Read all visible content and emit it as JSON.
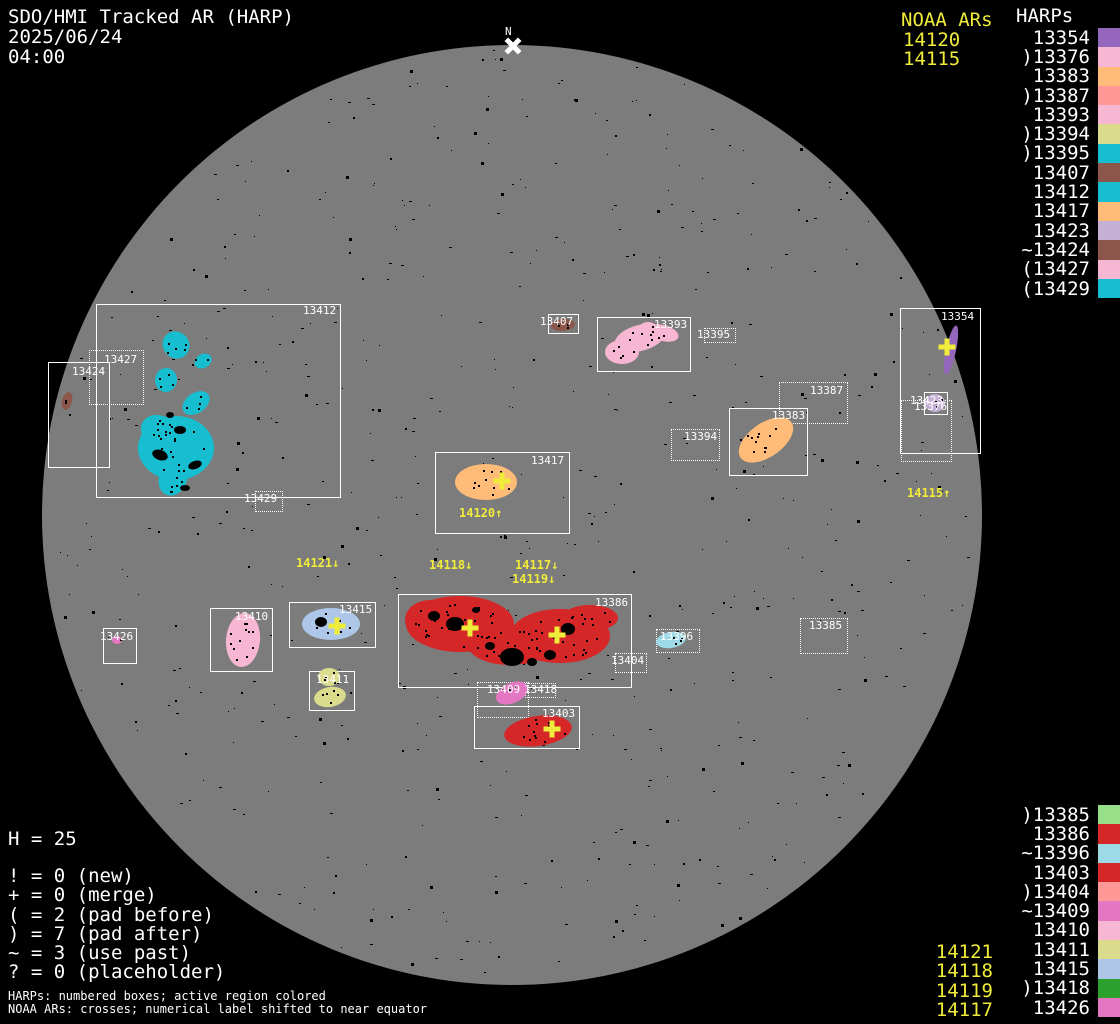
{
  "title": {
    "line1": "SDO/HMI Tracked AR (HARP)",
    "date": "2025/06/24",
    "time": "04:00"
  },
  "north": {
    "label": "N"
  },
  "colors": {
    "background": "#000000",
    "disk": "#7c7c7c",
    "box_line": "#ffffff",
    "noaa_yellow": "#f0ec3a"
  },
  "noaa_top": {
    "header": "NOAA ARs",
    "values": [
      "14120",
      "14115"
    ]
  },
  "harps": {
    "header": "HARPs",
    "top": [
      {
        "label": "13354",
        "color": "#9467bd"
      },
      {
        "label": ")13376",
        "color": "#f7b6d2"
      },
      {
        "label": "13383",
        "color": "#ffbb78"
      },
      {
        "label": ")13387",
        "color": "#ff9896"
      },
      {
        "label": "13393",
        "color": "#f7b6d2"
      },
      {
        "label": ")13394",
        "color": "#dbdb8d"
      },
      {
        "label": ")13395",
        "color": "#17becf"
      },
      {
        "label": "13407",
        "color": "#8c564b"
      },
      {
        "label": "13412",
        "color": "#17becf"
      },
      {
        "label": "13417",
        "color": "#ffbb78"
      },
      {
        "label": "13423",
        "color": "#c5b0d5"
      },
      {
        "label": "~13424",
        "color": "#8c564b"
      },
      {
        "label": "(13427",
        "color": "#f7b6d2"
      },
      {
        "label": "(13429",
        "color": "#17becf"
      }
    ],
    "bottom": [
      {
        "label": ")13385",
        "color": "#98df8a"
      },
      {
        "label": "13386",
        "color": "#d62728"
      },
      {
        "label": "~13396",
        "color": "#9edae5"
      },
      {
        "label": "13403",
        "color": "#d62728"
      },
      {
        "label": ")13404",
        "color": "#ff9896"
      },
      {
        "label": "~13409",
        "color": "#e377c2"
      },
      {
        "label": "13410",
        "color": "#f7b6d2"
      },
      {
        "label": "13411",
        "color": "#dbdb8d"
      },
      {
        "label": "13415",
        "color": "#aec7e8"
      },
      {
        "label": ")13418",
        "color": "#2ca02c"
      },
      {
        "label": "13426",
        "color": "#e377c2"
      }
    ]
  },
  "noaa_bottom": [
    "14121",
    "14118",
    "14119",
    "14117"
  ],
  "legend": {
    "h_line": "H = 25",
    "items": [
      "! = 0 (new)",
      "+ = 0 (merge)",
      "( = 2 (pad before)",
      ") = 7 (pad after)",
      "~ = 3 (use past)",
      "? = 0 (placeholder)"
    ],
    "footnote1": "HARPs: numbered boxes; active region colored",
    "footnote2": "NOAA ARs: crosses; numerical label shifted to near equator"
  },
  "disk": {
    "cx": 512,
    "cy": 515,
    "r": 470,
    "regions": [
      {
        "id": "13412",
        "box": [
          96,
          304,
          243,
          192
        ],
        "style": "solid",
        "label": [
          303,
          305
        ],
        "blobs": [
          [
            176,
            345,
            13,
            14,
            -40,
            "#17becf",
            5
          ],
          [
            203,
            361,
            9,
            7,
            -30,
            "#17becf",
            2
          ],
          [
            166,
            380,
            11,
            12,
            10,
            "#17becf",
            4
          ],
          [
            196,
            403,
            15,
            10,
            -35,
            "#17becf",
            4
          ],
          [
            176,
            448,
            38,
            32,
            0,
            "#17becf",
            18
          ],
          [
            173,
            478,
            14,
            18,
            20,
            "#17becf",
            6
          ],
          [
            160,
            432,
            20,
            16,
            30,
            "#17becf",
            6
          ],
          [
            180,
            430,
            6,
            4,
            0,
            "#000000",
            0
          ],
          [
            160,
            455,
            8,
            5,
            20,
            "#000000",
            0
          ],
          [
            195,
            465,
            7,
            4,
            -20,
            "#000000",
            0
          ],
          [
            170,
            415,
            4,
            3,
            0,
            "#000000",
            0
          ],
          [
            185,
            488,
            5,
            3,
            0,
            "#000000",
            0
          ]
        ]
      },
      {
        "id": "13427",
        "box": [
          89,
          350,
          53,
          53
        ],
        "style": "dotted",
        "label": [
          104,
          354
        ],
        "blobs": []
      },
      {
        "id": "13424",
        "box": [
          48,
          362,
          60,
          104
        ],
        "style": "solid",
        "label": [
          72,
          366
        ],
        "blobs": [
          [
            67,
            401,
            5,
            9,
            15,
            "#8c564b",
            2
          ]
        ]
      },
      {
        "id": "13429",
        "box": [
          255,
          491,
          26,
          19
        ],
        "style": "dotted",
        "label": [
          244,
          493
        ],
        "blobs": []
      },
      {
        "id": "13407",
        "box": [
          548,
          314,
          29,
          18
        ],
        "style": "solid",
        "label": [
          540,
          316
        ],
        "blobs": [
          [
            563,
            325,
            12,
            6,
            -5,
            "#8c564b",
            4
          ]
        ]
      },
      {
        "id": "13393",
        "box": [
          597,
          317,
          92,
          53
        ],
        "style": "solid",
        "label": [
          654,
          319
        ],
        "blobs": [
          [
            640,
            338,
            26,
            13,
            -15,
            "#f7b6d2",
            6
          ],
          [
            622,
            352,
            17,
            12,
            0,
            "#f7b6d2",
            5
          ],
          [
            663,
            333,
            16,
            8,
            15,
            "#f7b6d2",
            3
          ],
          [
            648,
            330,
            10,
            8,
            0,
            "#f7b6d2",
            2
          ]
        ]
      },
      {
        "id": "13395",
        "box": [
          704,
          328,
          30,
          13
        ],
        "style": "dotted",
        "label": [
          697,
          329
        ],
        "blobs": []
      },
      {
        "id": "13387",
        "box": [
          779,
          382,
          67,
          40
        ],
        "style": "dotted",
        "label": [
          810,
          385
        ],
        "blobs": []
      },
      {
        "id": "13383",
        "box": [
          729,
          408,
          77,
          66
        ],
        "style": "solid",
        "label": [
          772,
          410
        ],
        "blobs": [
          [
            766,
            440,
            31,
            17,
            -35,
            "#ffbb78",
            12
          ]
        ]
      },
      {
        "id": "13394",
        "box": [
          671,
          429,
          47,
          30
        ],
        "style": "dotted",
        "label": [
          684,
          431
        ],
        "blobs": []
      },
      {
        "id": "13354",
        "box": [
          900,
          308,
          79,
          144
        ],
        "style": "solid",
        "label": [
          941,
          311
        ],
        "blobs": [
          [
            951,
            350,
            5,
            25,
            12,
            "#9467bd",
            0
          ]
        ]
      },
      {
        "id": "13423",
        "box": [
          924,
          392,
          22,
          21
        ],
        "style": "solid",
        "label": [
          910,
          395
        ],
        "blobs": [
          [
            935,
            403,
            10,
            9,
            0,
            "#c5b0d5",
            3
          ]
        ]
      },
      {
        "id": "13376",
        "box": [
          901,
          400,
          49,
          60
        ],
        "style": "dotted",
        "label": [
          914,
          401
        ],
        "blobs": []
      },
      {
        "id": "13417",
        "box": [
          435,
          452,
          133,
          80
        ],
        "style": "solid",
        "label": [
          531,
          455
        ],
        "blobs": [
          [
            486,
            482,
            31,
            18,
            0,
            "#ffbb78",
            14
          ]
        ]
      },
      {
        "id": "13386",
        "box": [
          398,
          594,
          232,
          92
        ],
        "style": "solid",
        "label": [
          595,
          597
        ],
        "blobs": [
          [
            460,
            624,
            54,
            28,
            0,
            "#d62728",
            22
          ],
          [
            560,
            636,
            50,
            27,
            0,
            "#d62728",
            22
          ],
          [
            510,
            645,
            42,
            20,
            0,
            "#d62728",
            12
          ],
          [
            590,
            618,
            28,
            13,
            0,
            "#d62728",
            6
          ],
          [
            430,
            620,
            25,
            20,
            0,
            "#d62728",
            8
          ],
          [
            455,
            624,
            9,
            7,
            0,
            "#000000",
            0
          ],
          [
            512,
            657,
            12,
            9,
            0,
            "#000000",
            0
          ],
          [
            568,
            629,
            7,
            6,
            0,
            "#000000",
            0
          ],
          [
            490,
            646,
            5,
            4,
            0,
            "#000000",
            0
          ],
          [
            434,
            616,
            6,
            5,
            0,
            "#000000",
            0
          ],
          [
            532,
            662,
            5,
            4,
            0,
            "#000000",
            0
          ],
          [
            476,
            610,
            4,
            3,
            0,
            "#000000",
            0
          ],
          [
            550,
            655,
            6,
            5,
            0,
            "#000000",
            0
          ]
        ]
      },
      {
        "id": "13404",
        "box": [
          615,
          653,
          30,
          18
        ],
        "style": "dotted",
        "label": [
          611,
          655
        ],
        "blobs": []
      },
      {
        "id": "13409",
        "box": [
          477,
          682,
          50,
          34
        ],
        "style": "dotted",
        "label": [
          487,
          684
        ],
        "blobs": [
          [
            512,
            693,
            17,
            10,
            -25,
            "#e377c2",
            3
          ]
        ]
      },
      {
        "id": "13418",
        "box": [
          525,
          683,
          29,
          13
        ],
        "style": "dotted",
        "label": [
          524,
          684
        ],
        "blobs": []
      },
      {
        "id": "13403",
        "box": [
          474,
          706,
          104,
          41
        ],
        "style": "solid",
        "label": [
          542,
          708
        ],
        "blobs": [
          [
            538,
            731,
            34,
            15,
            -8,
            "#d62728",
            12
          ]
        ]
      },
      {
        "id": "13410",
        "box": [
          210,
          608,
          61,
          62
        ],
        "style": "solid",
        "label": [
          235,
          611
        ],
        "blobs": [
          [
            243,
            640,
            17,
            27,
            5,
            "#f7b6d2",
            12
          ]
        ]
      },
      {
        "id": "13415",
        "box": [
          289,
          602,
          85,
          44
        ],
        "style": "solid",
        "label": [
          339,
          604
        ],
        "blobs": [
          [
            331,
            624,
            29,
            16,
            0,
            "#aec7e8",
            6
          ],
          [
            321,
            622,
            6,
            5,
            0,
            "#000000",
            0
          ]
        ]
      },
      {
        "id": "13426",
        "box": [
          103,
          628,
          32,
          34
        ],
        "style": "solid",
        "label": [
          100,
          631
        ],
        "blobs": [
          [
            117,
            640,
            5,
            4,
            0,
            "#e377c2",
            1
          ]
        ]
      },
      {
        "id": "13411",
        "box": [
          309,
          671,
          44,
          38
        ],
        "style": "solid",
        "label": [
          316,
          674
        ],
        "blobs": [
          [
            329,
            677,
            11,
            9,
            0,
            "#dbdb8d",
            4
          ],
          [
            330,
            697,
            16,
            10,
            -10,
            "#dbdb8d",
            5
          ]
        ]
      },
      {
        "id": "13396",
        "box": [
          656,
          629,
          42,
          22
        ],
        "style": "dotted",
        "label": [
          660,
          631
        ],
        "blobs": [
          [
            671,
            640,
            15,
            8,
            -10,
            "#9edae5",
            4
          ]
        ]
      },
      {
        "id": "13385",
        "box": [
          800,
          618,
          46,
          34
        ],
        "style": "dotted",
        "label": [
          809,
          620
        ],
        "blobs": []
      }
    ],
    "labels": [
      {
        "text": "14121↓",
        "x": 296,
        "y": 557
      },
      {
        "text": "14118↓",
        "x": 429,
        "y": 559
      },
      {
        "text": "14117↓",
        "x": 515,
        "y": 559
      },
      {
        "text": "14119↓",
        "x": 512,
        "y": 573
      },
      {
        "text": "14120↑",
        "x": 459,
        "y": 507
      },
      {
        "text": "14115↑",
        "x": 907,
        "y": 487
      }
    ],
    "crosses": [
      {
        "x": 470,
        "y": 628
      },
      {
        "x": 557,
        "y": 635
      },
      {
        "x": 552,
        "y": 729
      },
      {
        "x": 502,
        "y": 481
      },
      {
        "x": 337,
        "y": 626
      },
      {
        "x": 947,
        "y": 347
      }
    ]
  }
}
